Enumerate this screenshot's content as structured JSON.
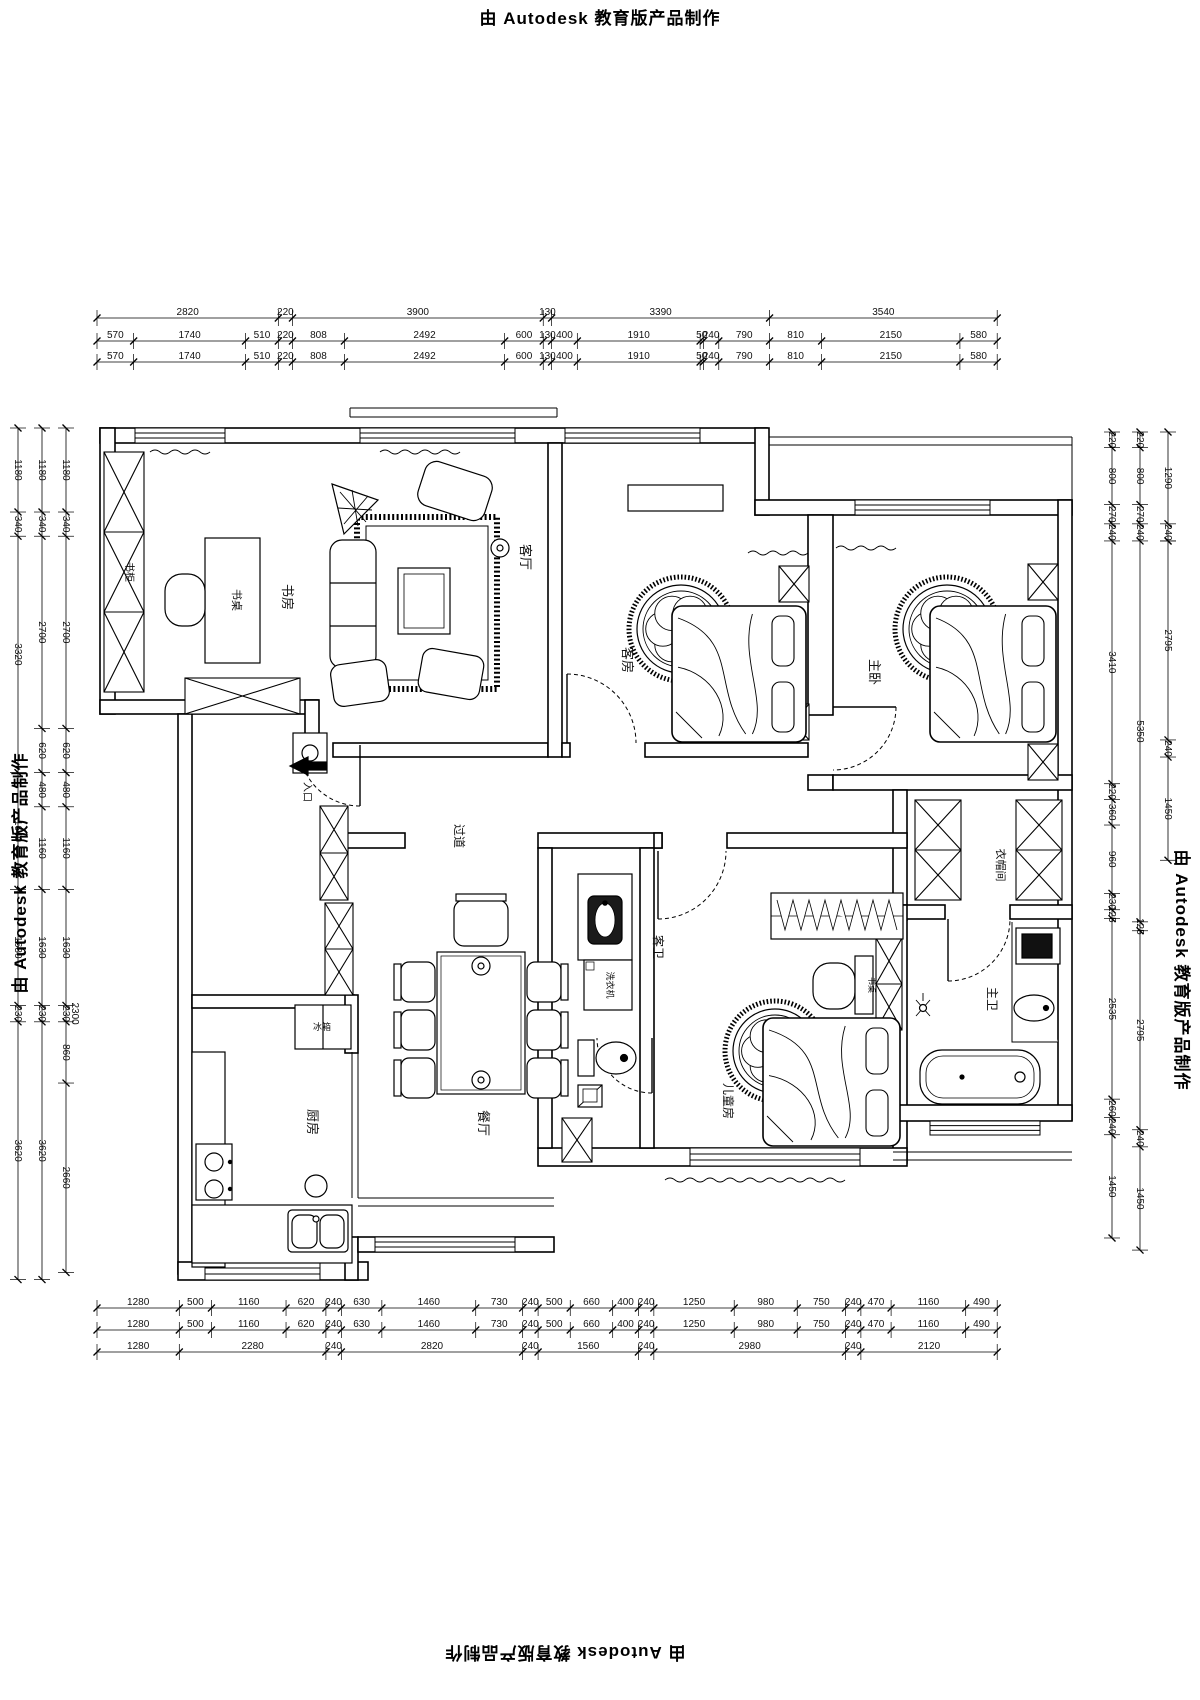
{
  "brand": "由 Autodesk 教育版产品制作",
  "rooms": {
    "study": "书房",
    "study_desk": "书桌",
    "bookcase": "书柜",
    "living": "客厅",
    "guest": "客房",
    "master": "主卧",
    "hallway": "过道",
    "entrance": "入口",
    "dining": "餐厅",
    "kitchen": "厨房",
    "fridge": "冰箱",
    "guest_bath": "客卫",
    "washer": "洗衣机",
    "children": "儿童房",
    "children_desk": "书桌",
    "closet": "衣帽间",
    "master_bath": "主卫"
  },
  "dimensions": {
    "top": [
      [
        2820,
        220,
        3900,
        130,
        3390,
        3540
      ],
      [
        570,
        1740,
        510,
        220,
        808,
        2492,
        600,
        130,
        400,
        1910,
        50,
        240,
        790,
        810,
        2150,
        580
      ],
      [
        570,
        1740,
        510,
        220,
        808,
        2492,
        600,
        130,
        400,
        1910,
        50,
        240,
        790,
        810,
        2150,
        580
      ]
    ],
    "bottom": [
      [
        1280,
        500,
        1160,
        620,
        240,
        630,
        1460,
        730,
        240,
        500,
        660,
        400,
        240,
        1250,
        980,
        750,
        240,
        470,
        1160,
        490
      ],
      [
        1280,
        500,
        1160,
        620,
        240,
        630,
        1460,
        730,
        240,
        500,
        660,
        400,
        240,
        1250,
        980,
        750,
        240,
        470,
        1160,
        490
      ],
      [
        1280,
        2280,
        240,
        2820,
        240,
        1560,
        240,
        2980,
        240,
        2120
      ]
    ],
    "left": [
      [
        1180,
        340,
        3320,
        1640,
        1630,
        230,
        3620
      ],
      [
        1180,
        340,
        2700,
        620,
        480,
        1160,
        1630,
        230,
        3620
      ],
      [
        1180,
        340,
        2700,
        620,
        480,
        1160,
        1630,
        230,
        860,
        2660
      ]
    ],
    "left_overlap": "2300",
    "right": [
      [
        220,
        800,
        270,
        240,
        3410,
        220,
        360,
        960,
        230,
        125,
        2535,
        260,
        240,
        1450
      ],
      [
        220,
        800,
        270,
        240,
        5350,
        125,
        2795,
        240,
        1450
      ],
      [
        1290,
        240,
        null,
        2795,
        240,
        1450
      ]
    ]
  }
}
